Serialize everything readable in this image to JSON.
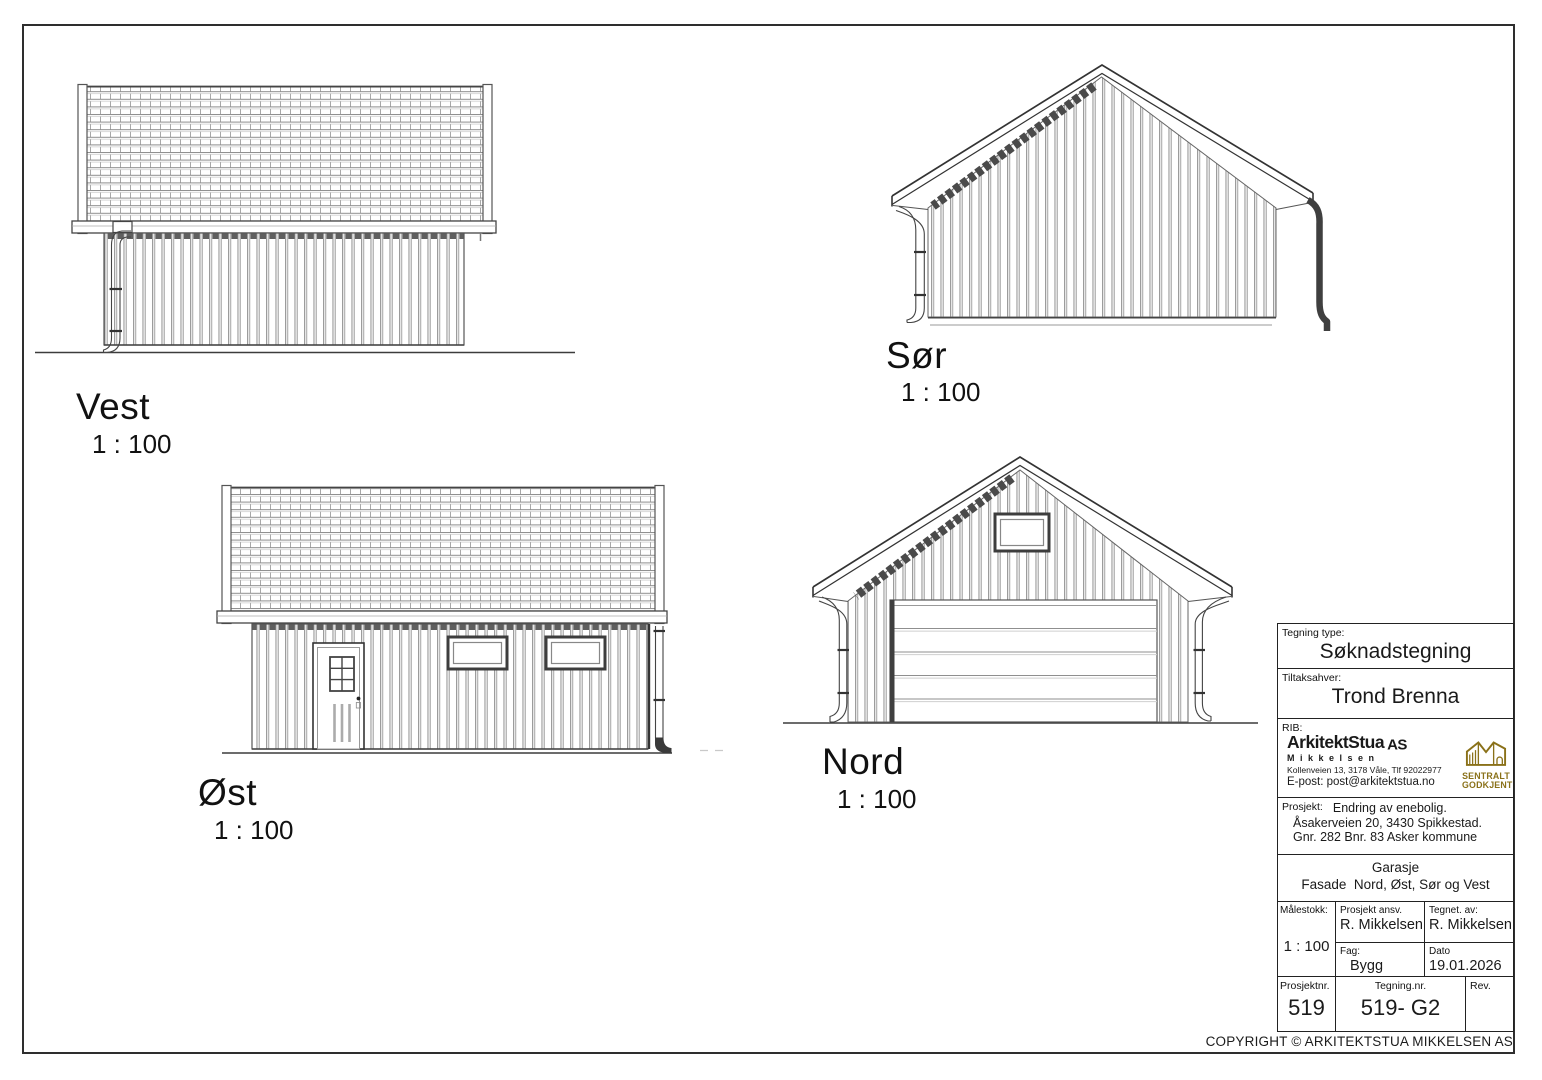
{
  "sheet": {
    "copyright": "COPYRIGHT © ARKITEKTSTUA MIKKELSEN AS"
  },
  "elevations": {
    "vest": {
      "label": "Vest",
      "scale": "1 : 100"
    },
    "sor": {
      "label": "Sør",
      "scale": "1 : 100"
    },
    "ost": {
      "label": "Øst",
      "scale": "1 : 100"
    },
    "nord": {
      "label": "Nord",
      "scale": "1 : 100"
    }
  },
  "title_block": {
    "tegning_type_label": "Tegning type:",
    "tegning_type": "Søknadstegning",
    "tiltakshaver_label": "Tiltaksahver:",
    "tiltakshaver": "Trond Brenna",
    "rib_label": "RIB:",
    "firm": {
      "name": "ArkitektStua",
      "name_suffix": "AS",
      "subname": "Mikkelsen",
      "address": "Kollenveien 13, 3178 Våle, Tlf 92022977",
      "email": "E-post: post@arkitektstua.no",
      "badge_line1": "SENTRALT",
      "badge_line2": "GODKJENT",
      "badge_color": "#8a7119"
    },
    "prosjekt_label": "Prosjekt:",
    "prosjekt_lines": [
      "Endring av enebolig.",
      "Åsakerveien 20, 3430 Spikkestad.",
      "Gnr. 282 Bnr. 83 Asker kommune"
    ],
    "drawing_title_line1": "Garasje",
    "drawing_title_line2": "Fasade  Nord, Øst, Sør og Vest",
    "malestokk_label": "Målestokk:",
    "malestokk": "1 : 100",
    "prosjekt_ansv_label": "Prosjekt ansv.",
    "prosjekt_ansv": "R. Mikkelsen",
    "tegnet_av_label": "Tegnet. av:",
    "tegnet_av": "R. Mikkelsen",
    "fag_label": "Fag:",
    "fag": "Bygg",
    "dato_label": "Dato",
    "dato": "19.01.2026",
    "prosjektnr_label": "Prosjektnr.",
    "prosjektnr": "519",
    "tegningnr_label": "Tegning.nr.",
    "tegningnr": "519- G2",
    "rev_label": "Rev."
  }
}
